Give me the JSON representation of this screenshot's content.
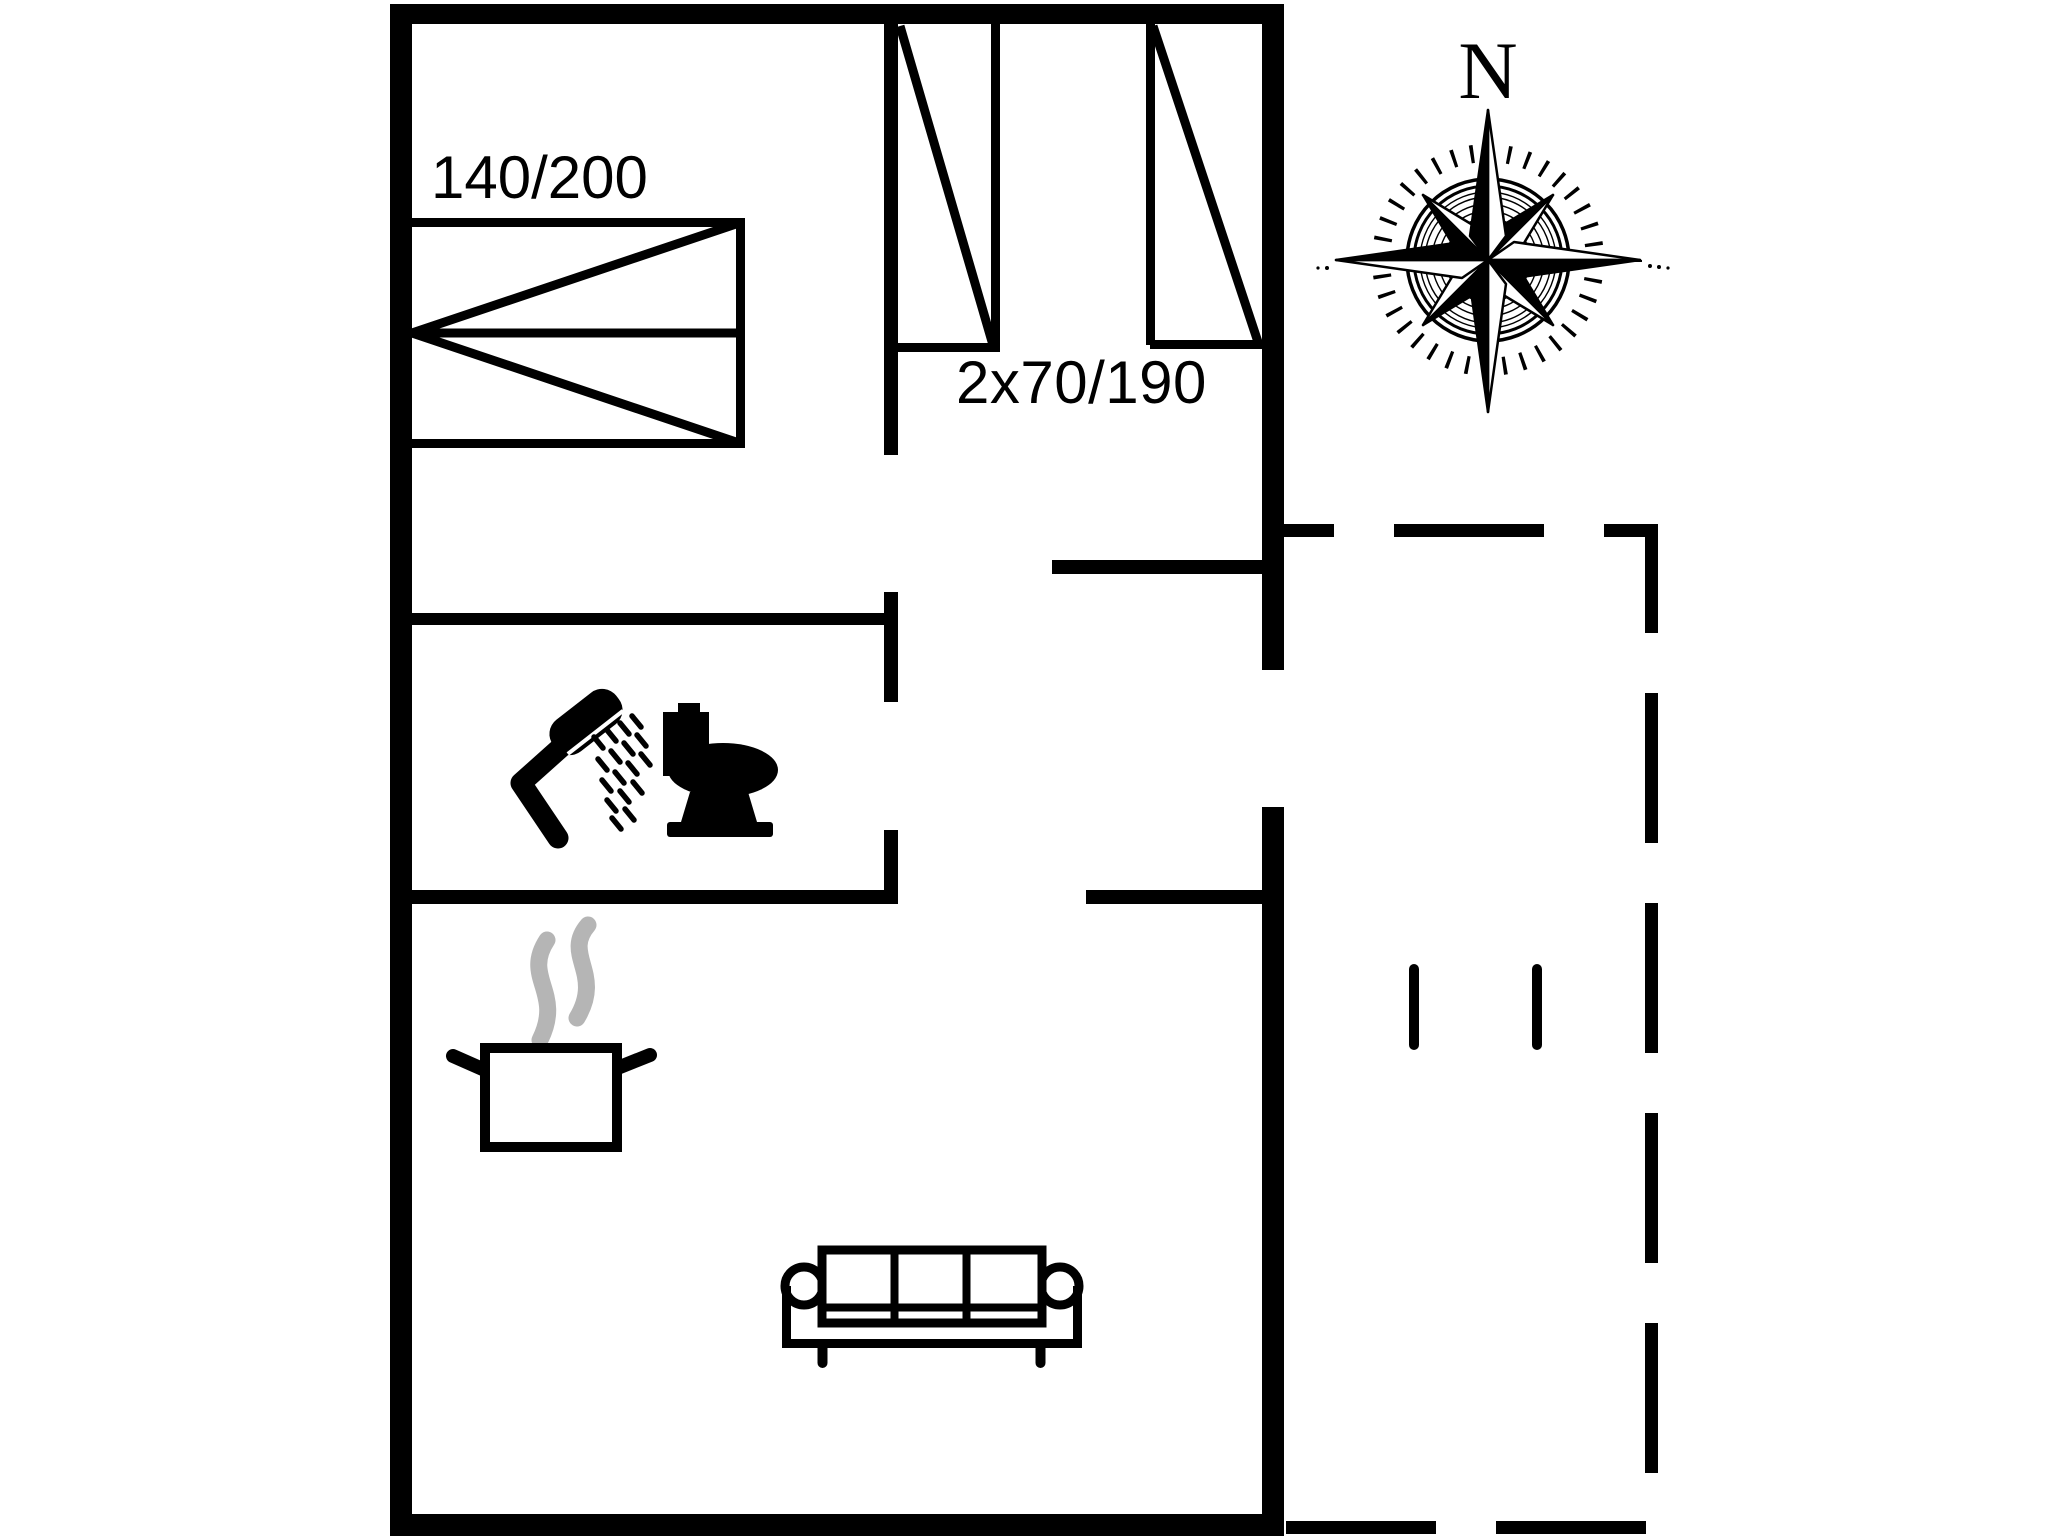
{
  "floor_plan": {
    "labels": {
      "double_bed_size": "140/200",
      "single_beds_size": "2x70/190",
      "compass_north": "N"
    },
    "colors": {
      "background": "#ffffff",
      "line": "#000000",
      "steam_gray": "#b5b5b5"
    },
    "icons": {
      "compass": "compass-rose-icon",
      "shower": "shower-icon",
      "toilet": "toilet-icon",
      "cooking_pot": "cooking-pot-icon",
      "steam": "steam-icon",
      "sofa": "sofa-icon",
      "double_bed": "double-bed-symbol",
      "single_beds": "single-bed-symbol",
      "terrace": "terrace-dashed-outline",
      "terrace_posts": "terrace-post-marks"
    }
  }
}
